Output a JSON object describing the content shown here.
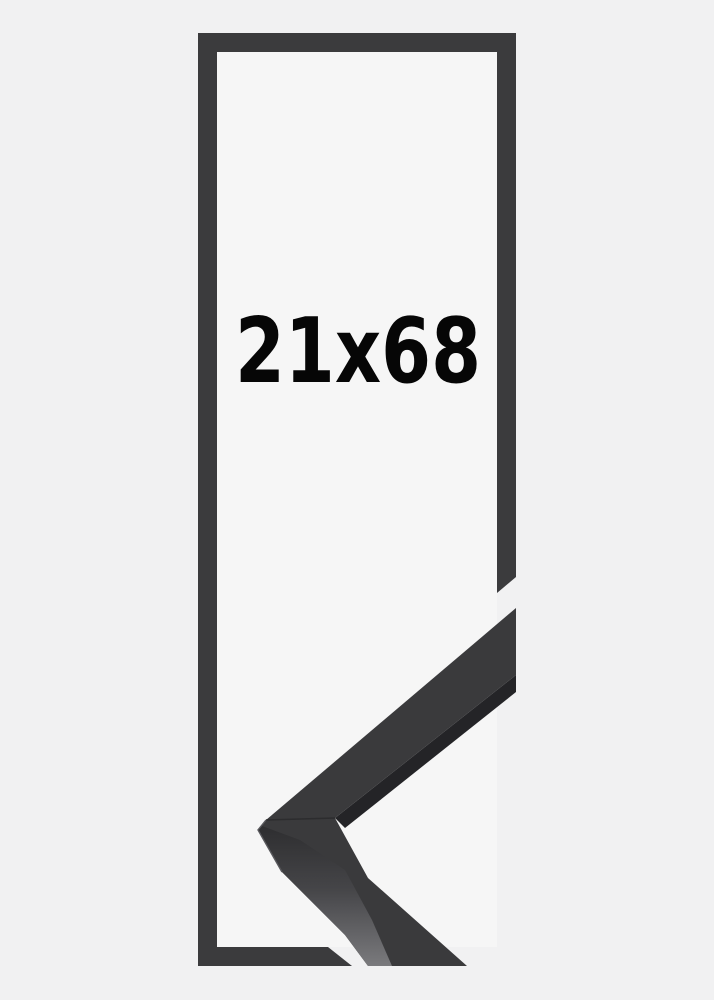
{
  "product": {
    "size_label": "21x68"
  },
  "colors": {
    "background": "#f1f1f2",
    "frame_inner_background": "#f6f6f6",
    "frame_graphic": "#3b3b3d",
    "label_text": "#060606",
    "moulding_face": "#3a3a3c",
    "moulding_edge_shadow": "#242427",
    "moulding_side_top": "#2e2e30",
    "moulding_side_bottom": "#7a7a7d",
    "moulding_seam": "#2c2c2e",
    "moulding_highlight": "#58585c"
  }
}
